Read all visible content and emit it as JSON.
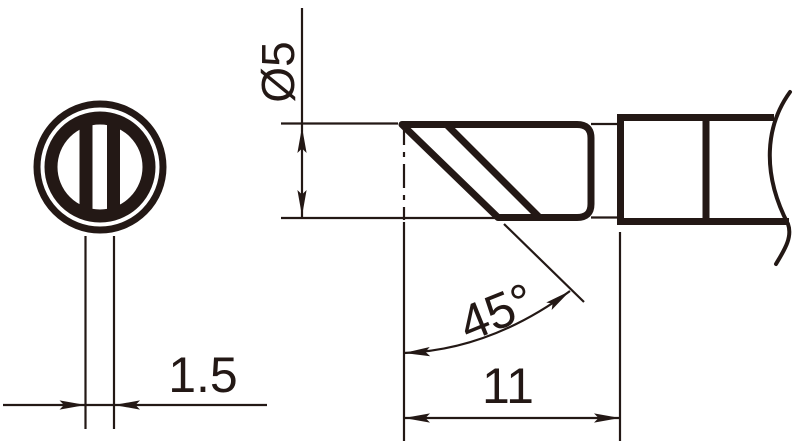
{
  "drawing": {
    "background_color": "#ffffff",
    "line_color": "#231815",
    "front_view": {
      "dimensions": {
        "edge_thickness": {
          "label": "1.5"
        }
      }
    },
    "side_view": {
      "dimensions": {
        "shank_diameter": {
          "label": "Ø5"
        },
        "bevel_angle": {
          "label": "45°"
        },
        "tip_length": {
          "label": "11"
        }
      }
    }
  }
}
